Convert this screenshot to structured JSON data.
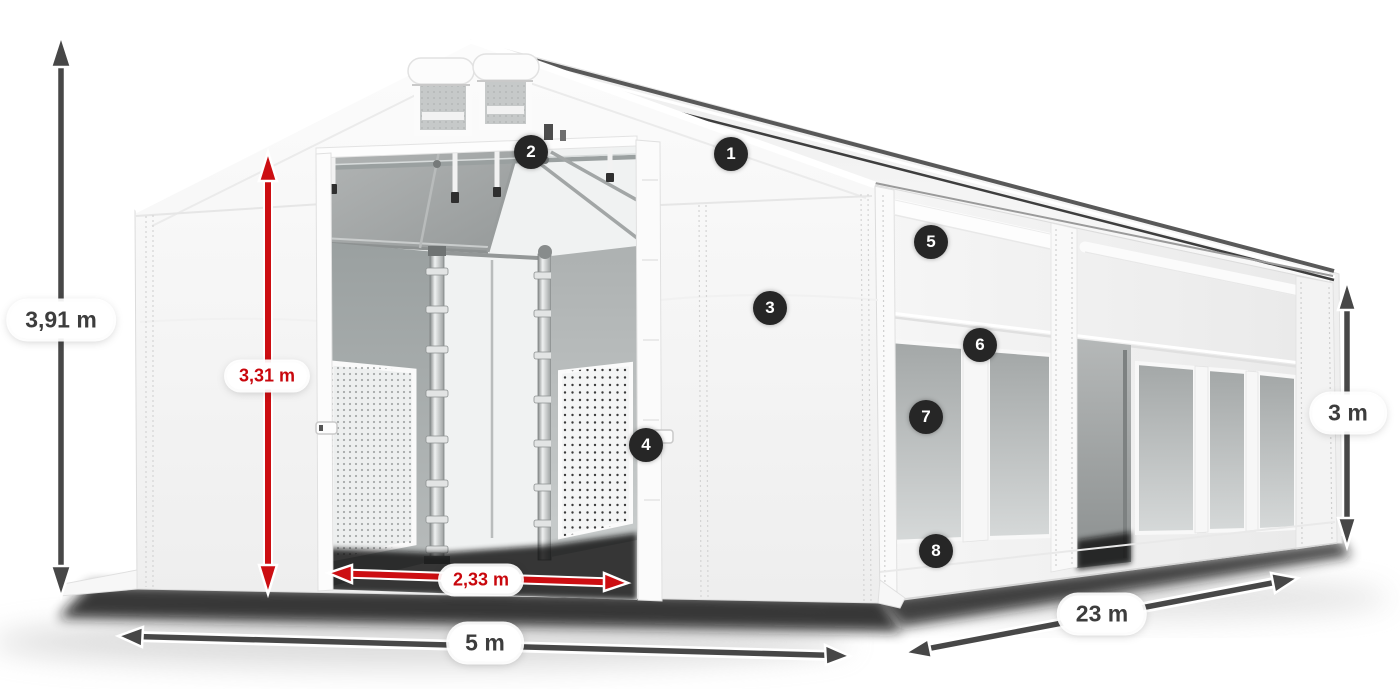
{
  "page": {
    "background": "#ffffff"
  },
  "diagram": {
    "type": "product-dimension-diagram",
    "subject": "white storage marquee tent, three-quarter view with numbered feature callouts",
    "dimensions": {
      "total_height": "3,91 m",
      "entrance_height": "3,31 m",
      "entrance_width": "2,33 m",
      "front_width": "5 m",
      "side_length": "23 m",
      "side_wall_height": "3 m"
    },
    "badges": [
      {
        "number": "1"
      },
      {
        "number": "2"
      },
      {
        "number": "3"
      },
      {
        "number": "4"
      },
      {
        "number": "5"
      },
      {
        "number": "6"
      },
      {
        "number": "7"
      },
      {
        "number": "8"
      }
    ],
    "colors": {
      "dimension_dark": "#3d3d3d",
      "dimension_red": "#c9070d",
      "arrow_dark": "#474747",
      "arrow_red": "#cc0e12",
      "badge_background": "#262626",
      "badge_number": "#ffffff",
      "tent_white": "#f6f6f6",
      "window_gray": "#b9bdbd"
    }
  }
}
